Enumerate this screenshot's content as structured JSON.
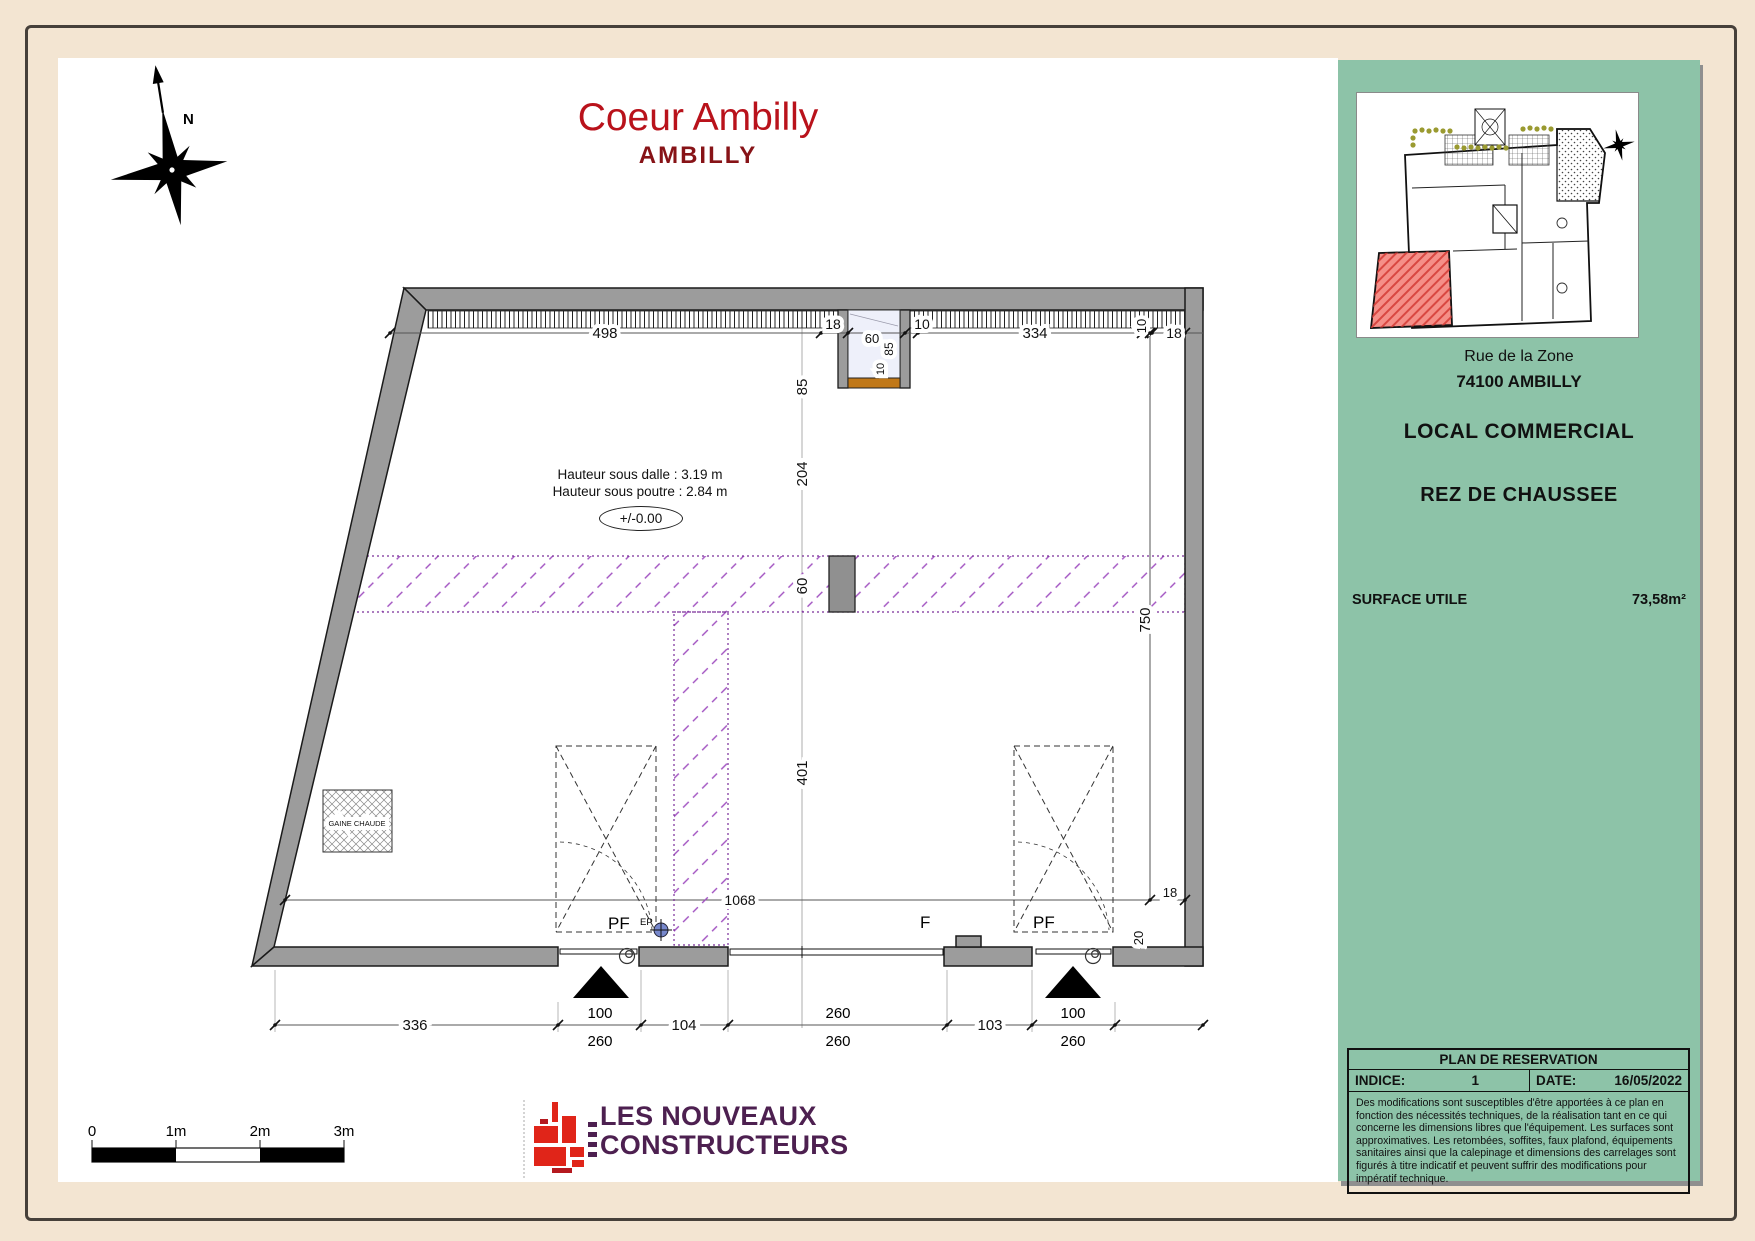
{
  "title": {
    "line1": "Coeur Ambilly",
    "line2": "AMBILLY"
  },
  "compass": {
    "north_label": "N"
  },
  "annotations": {
    "hauteur_dalle": "Hauteur sous dalle : 3.19 m",
    "hauteur_poutre": "Hauteur sous poutre : 2.84 m",
    "niveau": "+/-0.00",
    "gaine_chaude": "GAINE CHAUDE",
    "ep": "EP",
    "pf_left": "PF",
    "f_center": "F",
    "pf_right": "PF"
  },
  "dimensions": {
    "top": [
      "498",
      "18",
      "10",
      "334",
      "10",
      "18"
    ],
    "niche": {
      "width": "60",
      "depth": "85",
      "sill": "10"
    },
    "center_column": [
      "85",
      "204",
      "60",
      "401"
    ],
    "right": {
      "d750": "750",
      "d1068": "1068",
      "d18": "18",
      "d20": "20"
    },
    "bottom": [
      {
        "main": "336"
      },
      {
        "top": "100",
        "bottom": "260"
      },
      {
        "main": "104"
      },
      {
        "top": "260",
        "bottom": "260"
      },
      {
        "main": "103"
      },
      {
        "top": "100",
        "bottom": "260"
      }
    ]
  },
  "scale_bar": {
    "labels": [
      "0",
      "1m",
      "2m",
      "3m"
    ]
  },
  "sidebar": {
    "address_line1": "Rue de la Zone",
    "address_line2": "74100 AMBILLY",
    "program_type": "LOCAL COMMERCIAL",
    "level": "REZ DE CHAUSSEE",
    "surface_label": "SURFACE UTILE",
    "surface_value": "73,58m²",
    "table": {
      "header": "PLAN DE RESERVATION",
      "indice_label": "INDICE:",
      "indice_value": "1",
      "date_label": "DATE:",
      "date_value": "16/05/2022",
      "disclaimer": "Des modifications sont susceptibles d'être apportées à ce plan en fonction des nécessités techniques, de la réalisation tant en ce qui concerne les dimensions libres que l'équipement. Les surfaces sont approximatives. Les retombées, soffites, faux plafond, équipements sanitaires ainsi que la calepinage et dimensions des carrelages sont figurés à titre indicatif et peuvent suffrir des modifications pour impératif technique."
    }
  },
  "logo": {
    "line1": "LES NOUVEAUX",
    "line2": "CONSTRUCTEURS"
  },
  "colors": {
    "page_beige": "#f3e5d2",
    "panel_green": "#8dc3a8",
    "title_red": "#b9121b",
    "subtitle_red": "#871317",
    "wall_gray": "#9c9c9c",
    "purple_hatch": "#a050c0",
    "niche_sill_orange": "#c07818",
    "unit_red": "#f58f88",
    "logo_purple": "#4d2050",
    "logo_red": "#e02519"
  }
}
